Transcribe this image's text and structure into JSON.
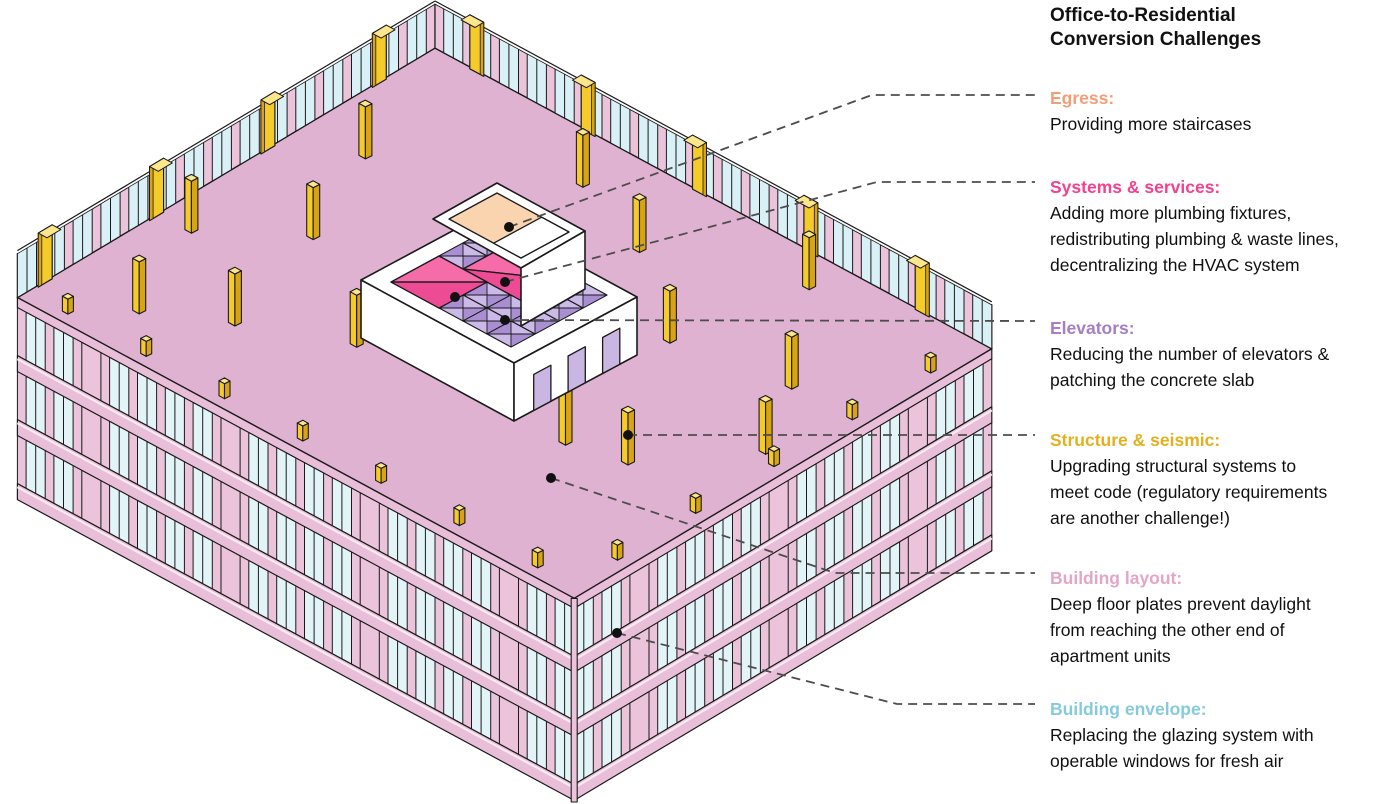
{
  "title": {
    "line1": "Office-to-Residential",
    "line2": "Conversion Challenges"
  },
  "legend": [
    {
      "id": "egress",
      "heading": "Egress:",
      "color": "#F49E78",
      "lines": [
        "Providing more staircases"
      ]
    },
    {
      "id": "systems",
      "heading": "Systems & services:",
      "color": "#F5418E",
      "lines": [
        "Adding more plumbing fixtures,",
        "redistributing plumbing & waste lines,",
        "decentralizing the HVAC system"
      ]
    },
    {
      "id": "elevators",
      "heading": "Elevators:",
      "color": "#A77EC5",
      "lines": [
        "Reducing the number of elevators &",
        "patching the concrete slab"
      ]
    },
    {
      "id": "structure",
      "heading": "Structure & seismic:",
      "color": "#E5B01F",
      "lines": [
        "Upgrading structural systems to",
        "meet code (regulatory requirements",
        "are another challenge!)"
      ]
    },
    {
      "id": "layout",
      "heading": "Building layout:",
      "color": "#E2A6C8",
      "lines": [
        "Deep floor plates prevent daylight",
        "from reaching the other end of",
        "apartment units"
      ]
    },
    {
      "id": "envelope",
      "heading": "Building envelope:",
      "color": "#85CBDC",
      "lines": [
        "Replacing the glazing system with",
        "operable windows for fresh air"
      ]
    }
  ],
  "zones": [
    {
      "name": "egress-stair-zone",
      "color": "#F9D4AE"
    },
    {
      "name": "systems-services-zone",
      "color": "#F2579D"
    },
    {
      "name": "elevator-zone",
      "color": "#CBB9E8"
    },
    {
      "name": "structural-column",
      "color": "#F5CB2B"
    },
    {
      "name": "floor-plate",
      "color": "#E0B2D1"
    },
    {
      "name": "glazing-envelope",
      "color": "#E3F4F8"
    }
  ],
  "palette": {
    "floor": "#E0B2D1",
    "panelPink": "#EBC4DC",
    "slabPink": "#E9BED8",
    "slabHighlight": "#F8E9F2",
    "glass": "#E3F4F8",
    "glassFar": "#D9F0F6",
    "yellow": "#F5CB2B",
    "yellowDark": "#D9A413",
    "yellowLight": "#FBE68C",
    "outline": "#1a1a1a",
    "white": "#FFFFFF",
    "peach": "#F9D4AE",
    "corePink": "#F2579D",
    "corePinkDark": "#EE4B95",
    "corePinkLight": "#F56CA8",
    "purpleLight": "#CBB9E8",
    "purpleDark": "#A98FD2",
    "lavender": "#C9B6E3",
    "dash": "#4d4d4d",
    "dot": "#111111"
  }
}
